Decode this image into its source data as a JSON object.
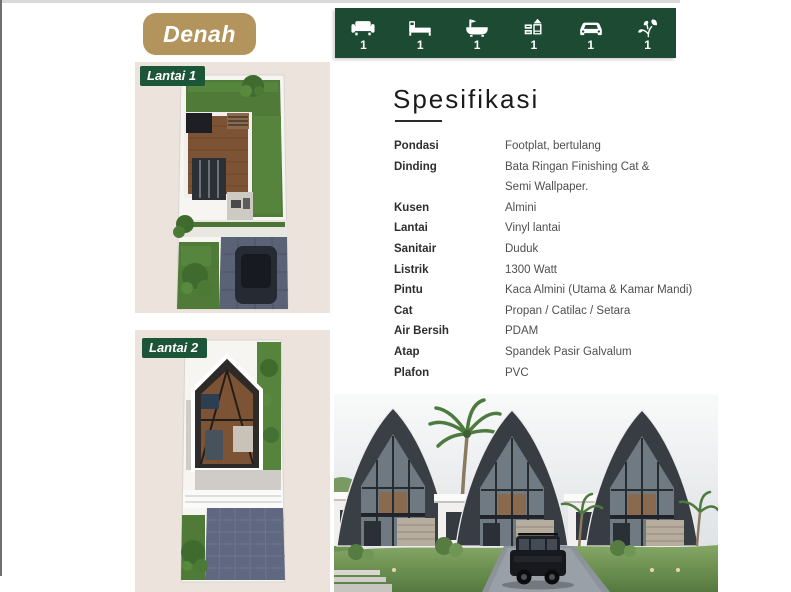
{
  "badge": {
    "label": "Denah"
  },
  "amenities": [
    {
      "icon": "sofa-icon",
      "count": "1"
    },
    {
      "icon": "bed-icon",
      "count": "1"
    },
    {
      "icon": "bathtub-icon",
      "count": "1"
    },
    {
      "icon": "kitchen-icon",
      "count": "1"
    },
    {
      "icon": "car-icon",
      "count": "1"
    },
    {
      "icon": "plant-icon",
      "count": "1"
    }
  ],
  "floorplans": {
    "floor1_label": "Lantai 1",
    "floor2_label": "Lantai 2"
  },
  "specs": {
    "heading": "Spesifikasi",
    "rows": [
      {
        "label": "Pondasi",
        "value": "Footplat, bertulang"
      },
      {
        "label": "Dinding",
        "value": "Bata Ringan Finishing Cat &",
        "value_line2": "Semi Wallpaper."
      },
      {
        "label": "Kusen",
        "value": "Almini"
      },
      {
        "label": "Lantai",
        "value": "Vinyl lantai"
      },
      {
        "label": "Sanitair",
        "value": "Duduk"
      },
      {
        "label": "Listrik",
        "value": "1300 Watt"
      },
      {
        "label": "Pintu",
        "value": "Kaca Almini (Utama & Kamar Mandi)"
      },
      {
        "label": "Cat",
        "value": "Propan / Catilac / Setara"
      },
      {
        "label": "Air Bersih",
        "value": "PDAM"
      },
      {
        "label": "Atap",
        "value": "Spandek Pasir Galvalum"
      },
      {
        "label": "Plafon",
        "value": "PVC"
      }
    ]
  },
  "colors": {
    "brand_green": "#1d4a33",
    "badge_green": "#1d5538",
    "gold": "#b2945c",
    "panel_beige": "#ece3dd"
  }
}
